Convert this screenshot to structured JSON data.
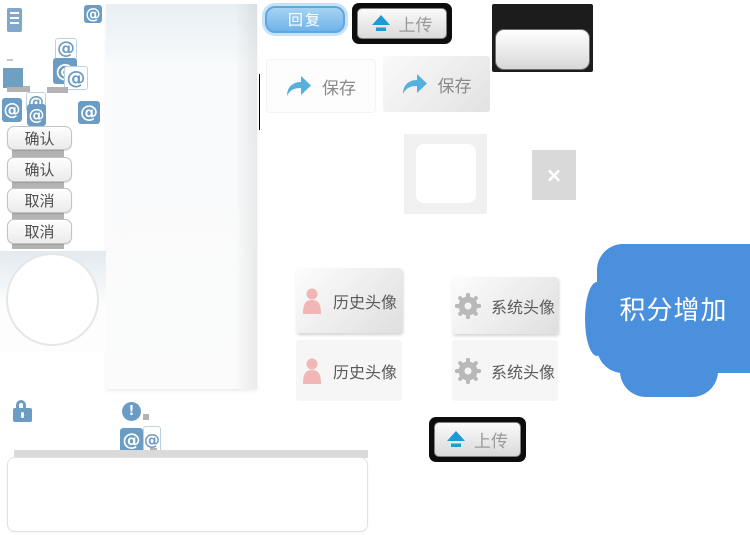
{
  "sprites": {
    "at_symbol": "@",
    "close_glyph": "×",
    "exclamation_glyph": "!"
  },
  "buttons": {
    "reply": "回复",
    "upload": "上传",
    "save": "保存",
    "confirm": "确认",
    "cancel": "取消",
    "history_avatar": "历史头像",
    "system_avatar": "系统头像"
  },
  "bubble": {
    "text": "积分增加",
    "color": "#4a90dd"
  },
  "colors": {
    "icon_blue": "#6b9cc3",
    "reply_button_blue": "#6fb4e9",
    "upload_arrow_blue": "#1e9ad7",
    "save_arrow_blue": "#56b0dd",
    "avatar_person_pink": "#f2b6b6",
    "gear_gray": "#b9b9b9",
    "black_panel": "#1c1c1c"
  }
}
